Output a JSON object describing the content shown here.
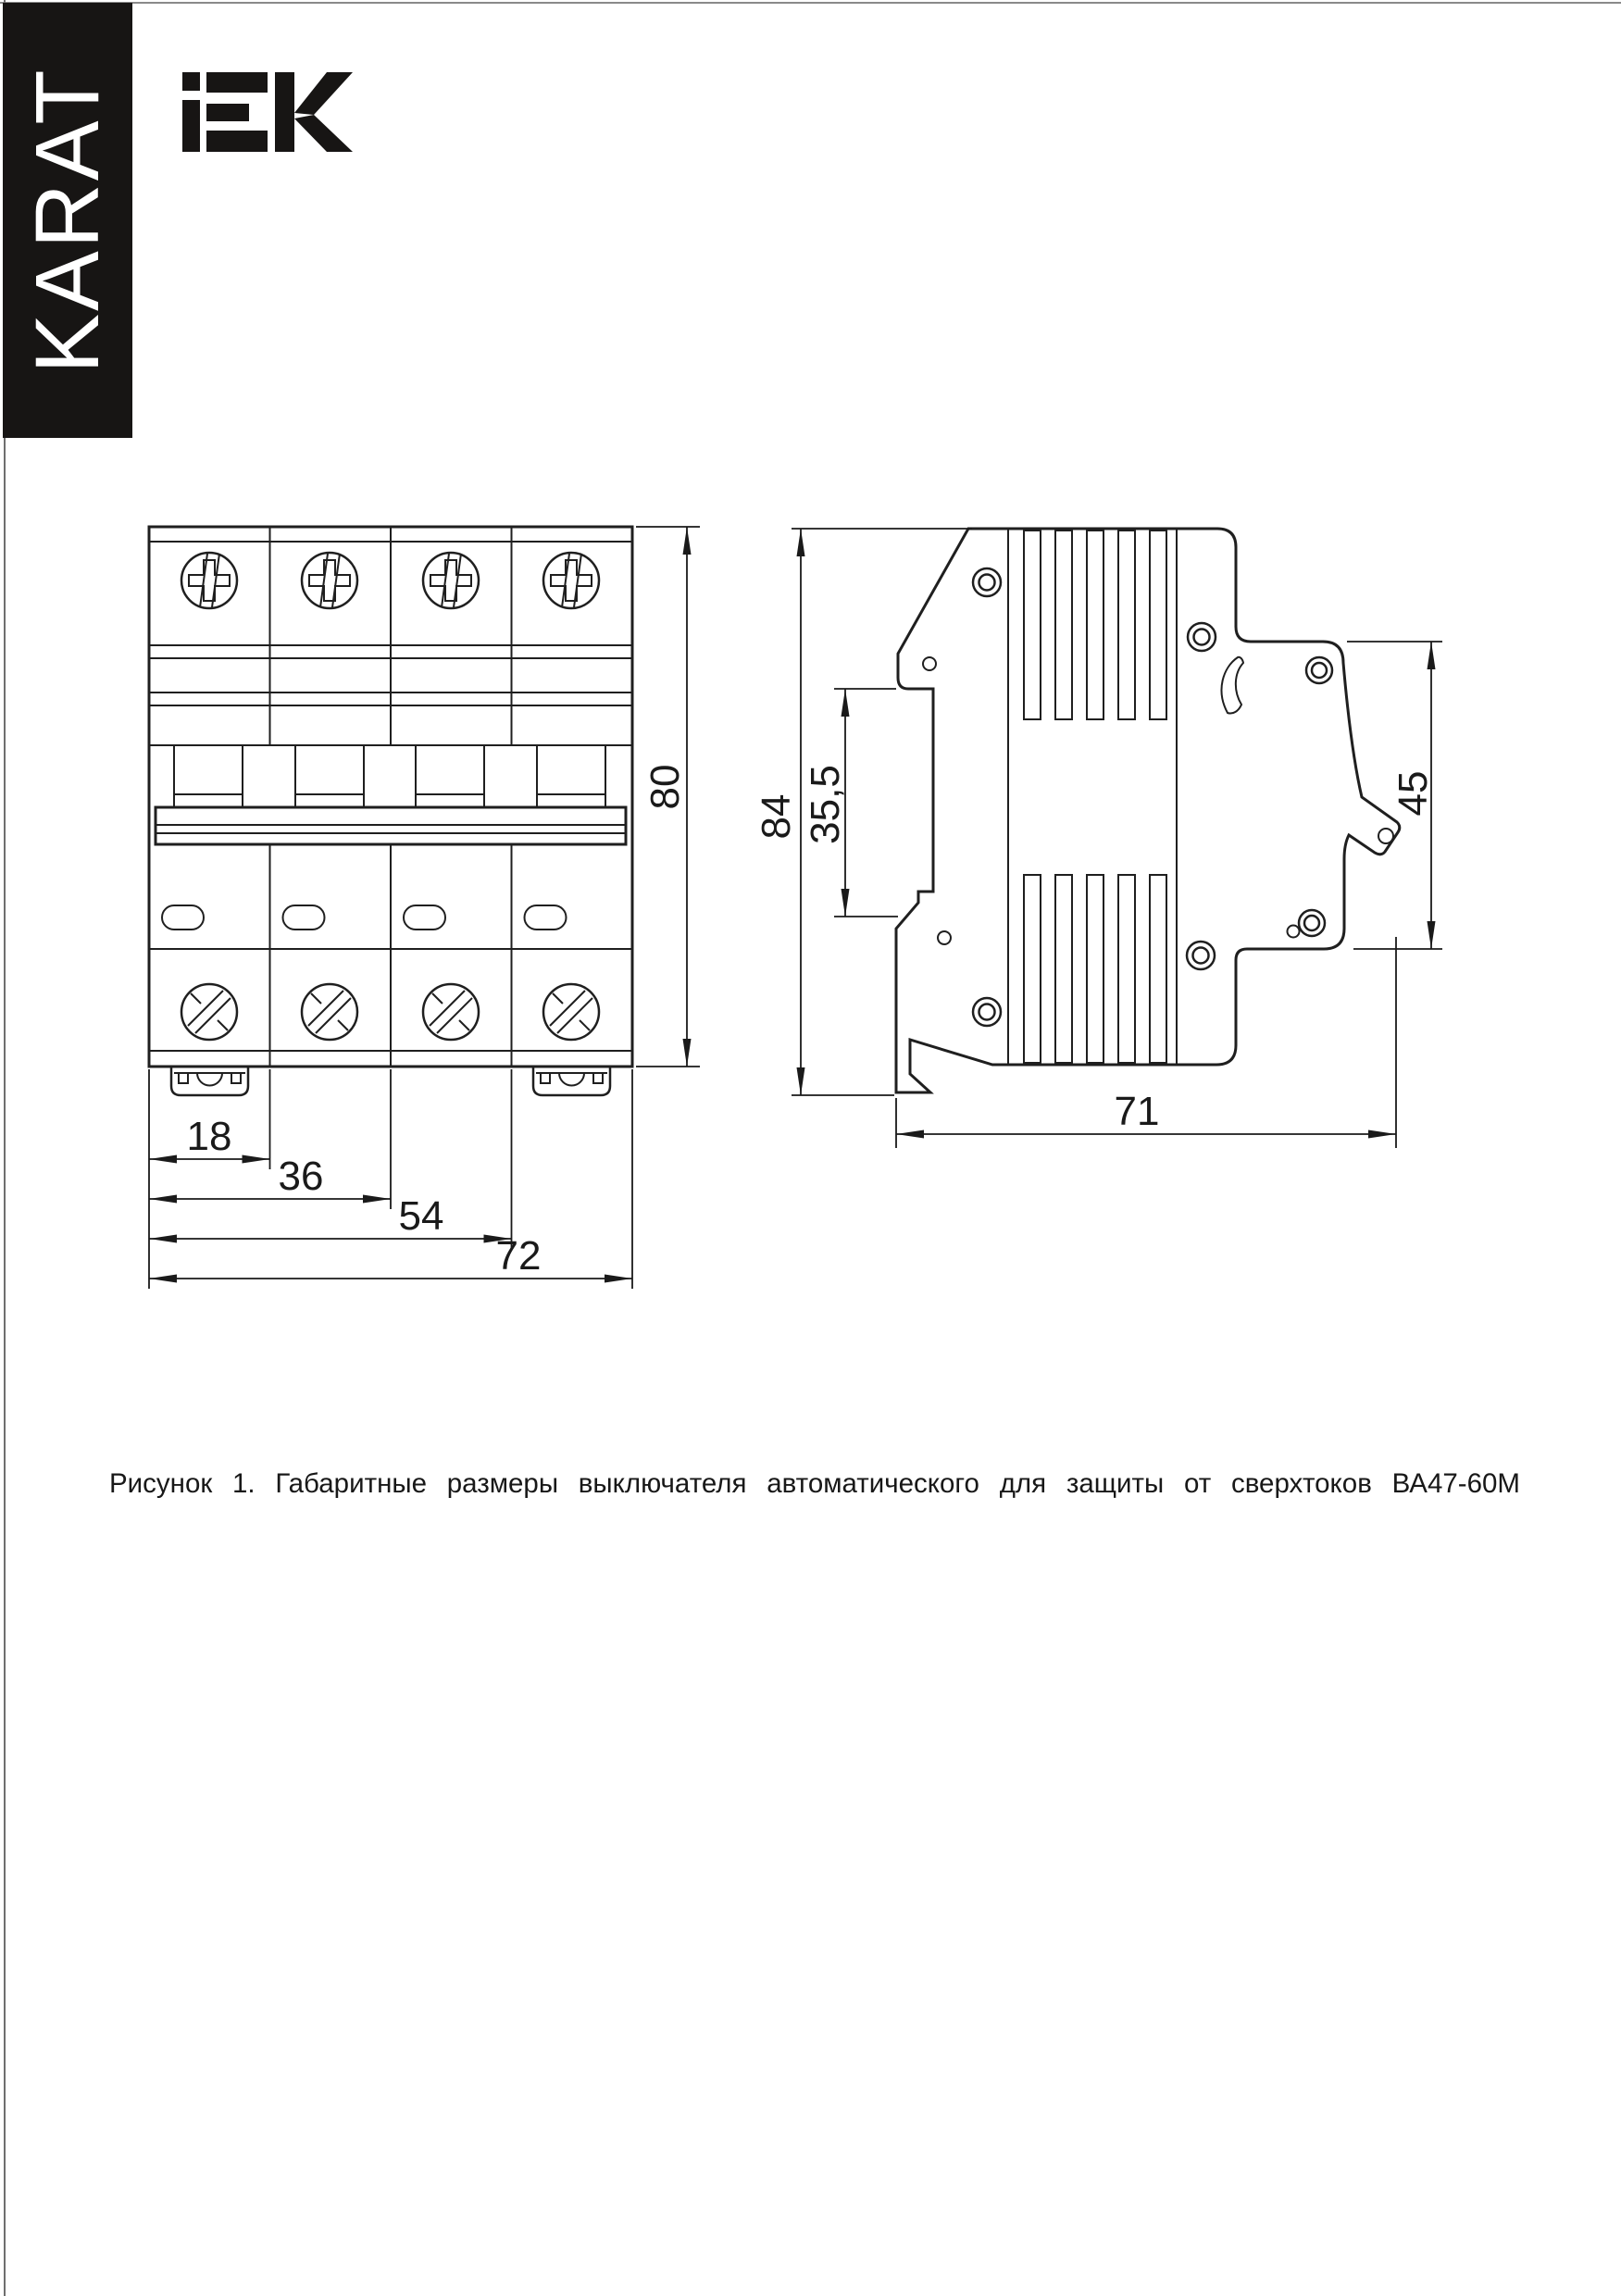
{
  "page": {
    "brand_sidebar": {
      "label": "KARAT"
    },
    "logo": {
      "text": "IEK"
    },
    "figure": {
      "caption": "Рисунок 1. Габаритные размеры выключателя автоматического для защиты от сверхтоков ВА47-60М",
      "product": "ВА47-60М",
      "dimensions_mm": {
        "d18": "18",
        "d36": "36",
        "d54": "54",
        "d72": "72",
        "d80": "80",
        "d84": "84",
        "d35_5": "35,5",
        "d45": "45",
        "d71": "71"
      }
    }
  }
}
